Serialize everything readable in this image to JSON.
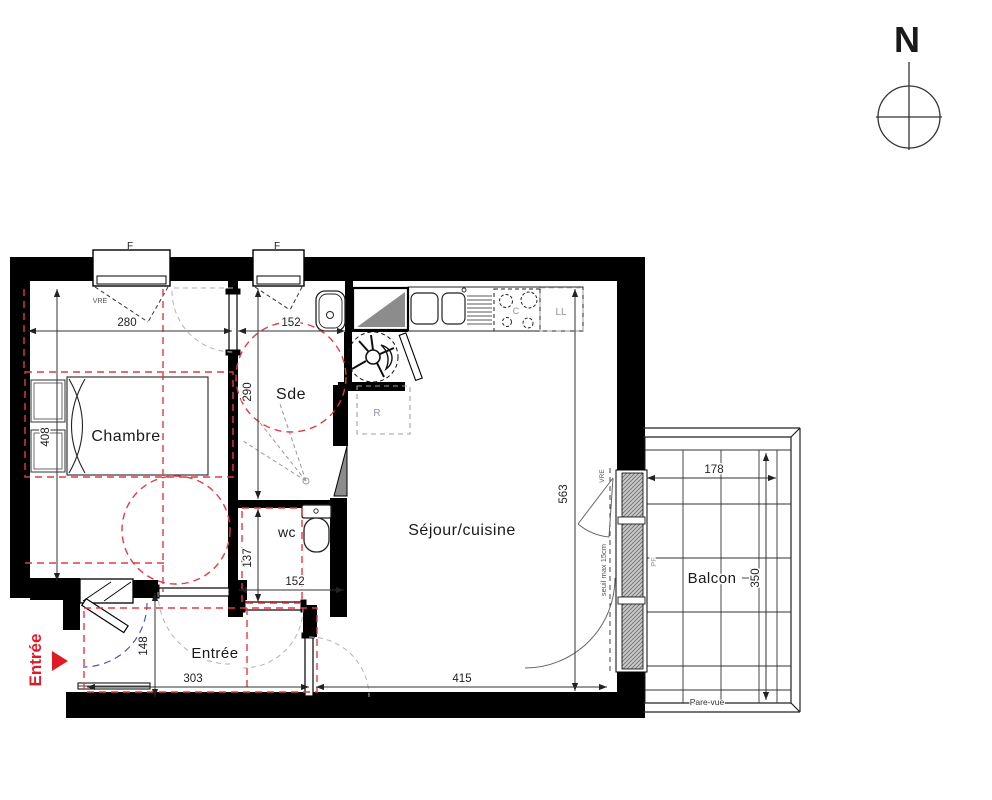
{
  "compass": {
    "label": "N"
  },
  "entry_marker": {
    "label": "Entrée"
  },
  "rooms": {
    "chambre": "Chambre",
    "sde": "Sde",
    "wc": "wc",
    "sejour": "Séjour/cuisine",
    "entree": "Entrée",
    "balcon": "Balcon"
  },
  "dimensions_cm": {
    "chambre_width": "280",
    "sde_width": "152",
    "sde_depth": "290",
    "chambre_depth": "408",
    "sejour_depth": "563",
    "wc_depth": "137",
    "wc_width": "152",
    "entree_depth": "148",
    "entree_width": "303",
    "sejour_width": "415",
    "balcon_width": "178",
    "balcon_depth": "350"
  },
  "annotations": {
    "window1": "F",
    "window2": "F",
    "vre_top": "VRE",
    "vre_window": "VRE",
    "washer": "LL",
    "cooktop": "C",
    "fridge": "R",
    "pf": "PF",
    "seuil": "seuil max 15cm",
    "pare_vue": "Pare-vue"
  },
  "colors": {
    "walls": "#000000",
    "accessibility_red": "#e23b41",
    "entry_red": "#e01b24",
    "annotation_gray": "#8b93a4",
    "door_swing_blue": "#5050c0"
  }
}
